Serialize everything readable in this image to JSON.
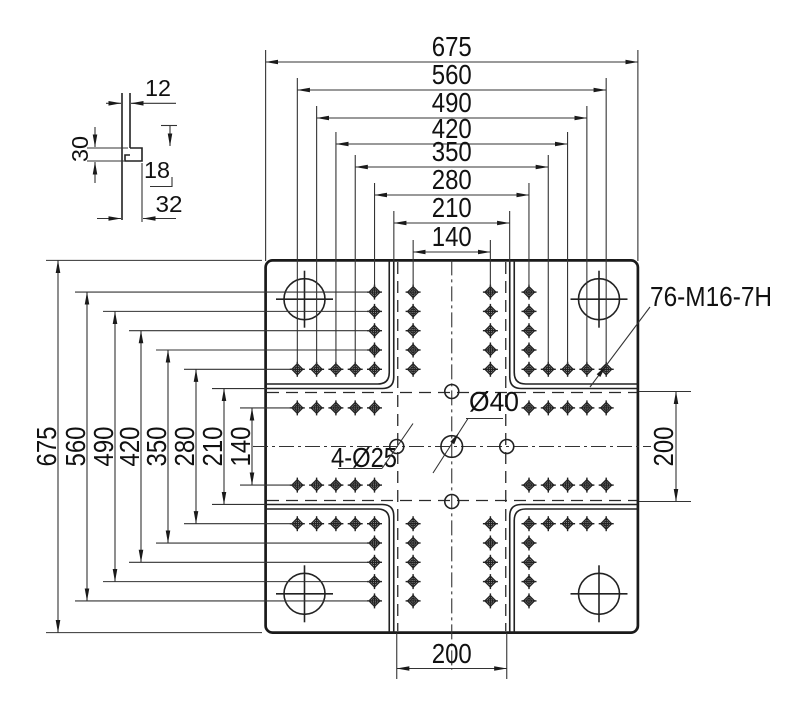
{
  "drawing": {
    "top_dimensions": [
      {
        "label": "675",
        "mm": 675
      },
      {
        "label": "560",
        "mm": 560
      },
      {
        "label": "490",
        "mm": 490
      },
      {
        "label": "420",
        "mm": 420
      },
      {
        "label": "350",
        "mm": 350
      },
      {
        "label": "280",
        "mm": 280
      },
      {
        "label": "210",
        "mm": 210
      },
      {
        "label": "140",
        "mm": 140
      }
    ],
    "left_dimensions": [
      {
        "label": "675",
        "mm": 675
      },
      {
        "label": "560",
        "mm": 560
      },
      {
        "label": "490",
        "mm": 490
      },
      {
        "label": "420",
        "mm": 420
      },
      {
        "label": "350",
        "mm": 350
      },
      {
        "label": "280",
        "mm": 280
      },
      {
        "label": "210",
        "mm": 210
      },
      {
        "label": "140",
        "mm": 140
      }
    ],
    "labels": {
      "thread_holes": "76-M16-7H",
      "center_hole": "Ø40",
      "locating_holes": "4-Ø25",
      "pattern_width": "200",
      "pattern_height": "200"
    },
    "detail_view": {
      "top_width": "12",
      "depth": "30",
      "step": "18",
      "bottom_width": "32"
    },
    "plate": {
      "size_mm": 675,
      "hole_grid_mm": [
        140,
        175,
        210,
        245,
        280
      ],
      "channel_offset_mm": 70,
      "locating_pattern_mm": 200
    }
  }
}
